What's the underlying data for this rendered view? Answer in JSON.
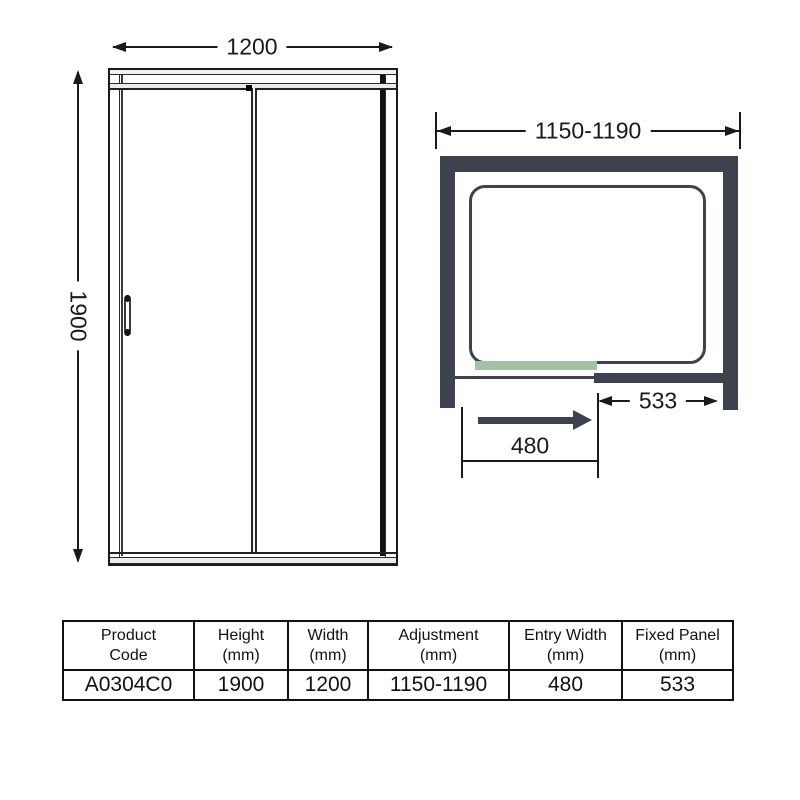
{
  "diagram": {
    "front_elevation": {
      "width_mm": "1200",
      "height_mm": "1900"
    },
    "plan_view": {
      "adjustment_mm": "1150-1190",
      "fixed_panel_mm": "533",
      "entry_width_mm": "480"
    }
  },
  "colors": {
    "wall": "#3d424e",
    "panel-green": "#a5c1a5",
    "line": "#1a1a1a"
  },
  "table": {
    "headers": [
      {
        "line1": "Product",
        "line2": "Code"
      },
      {
        "line1": "Height",
        "line2": "(mm)"
      },
      {
        "line1": "Width",
        "line2": "(mm)"
      },
      {
        "line1": "Adjustment",
        "line2": "(mm)"
      },
      {
        "line1": "Entry Width",
        "line2": "(mm)"
      },
      {
        "line1": "Fixed Panel",
        "line2": "(mm)"
      }
    ],
    "row": {
      "product_code": "A0304C0",
      "height": "1900",
      "width": "1200",
      "adjustment": "1150-1190",
      "entry_width": "480",
      "fixed_panel": "533"
    }
  }
}
